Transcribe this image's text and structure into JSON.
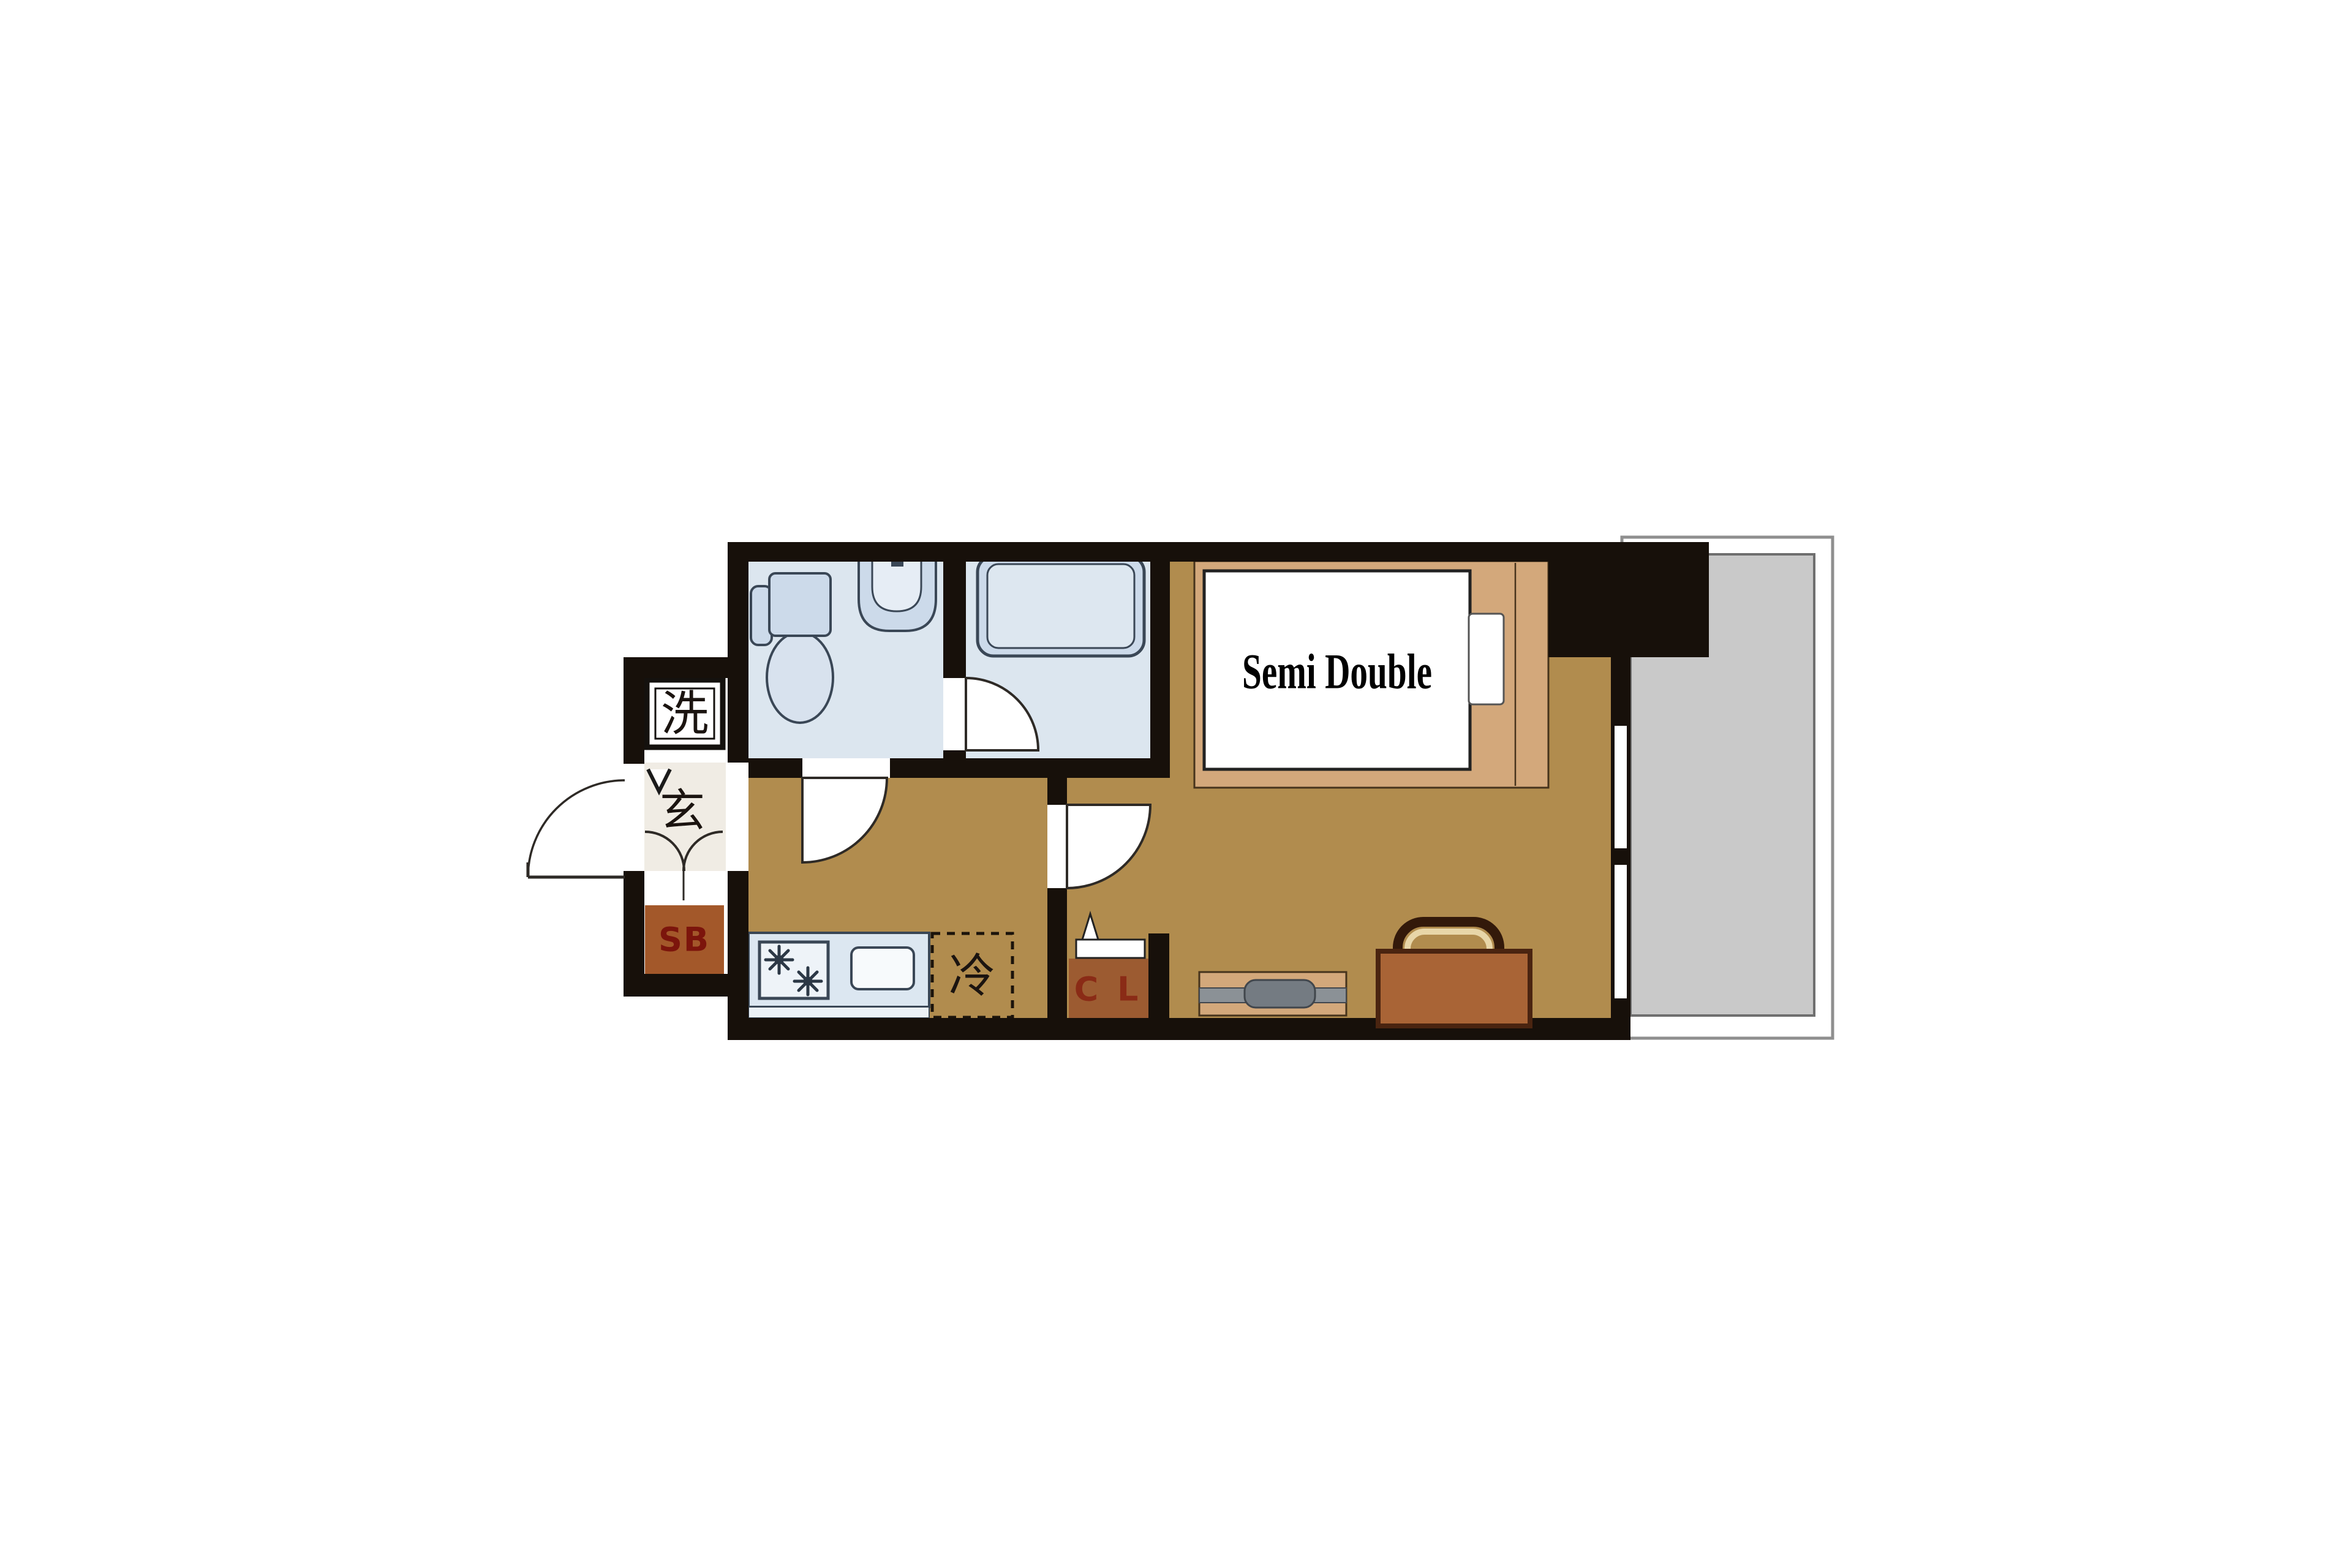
{
  "floorplan": {
    "type": "japanese-apartment-1K-floorplan",
    "labels": {
      "washer": "洗",
      "entrance": "玄",
      "shoe_box": "SB",
      "refrigerator": "冷",
      "closet": "C L",
      "bed": "Semi Double"
    },
    "rooms": [
      {
        "name": "toilet-room",
        "fixtures": [
          "toilet",
          "hand-basin"
        ]
      },
      {
        "name": "bathroom",
        "fixtures": [
          "bathtub"
        ]
      },
      {
        "name": "kitchen-hallway",
        "fixtures": [
          "two-burner-stove",
          "kitchen-sink",
          "refrigerator-space"
        ]
      },
      {
        "name": "entrance-hall",
        "fixtures": [
          "washing-machine-space",
          "shoe-box",
          "front-door"
        ]
      },
      {
        "name": "bedroom",
        "fixtures": [
          "semi-double-bed",
          "pillow",
          "closet",
          "tv-board",
          "suitcase"
        ]
      },
      {
        "name": "balcony",
        "fixtures": [
          "sliding-window"
        ]
      }
    ],
    "colors": {
      "background": "#ffffff",
      "wall": "#17100a",
      "floor_tan": "#b18c4e",
      "wet_room_blue": "#dce6ef",
      "fixture_fill": "#ccdaea",
      "fixture_outline": "#3a4756",
      "counter_blue": "#dce7f1",
      "genkan_beige": "#f0ece4",
      "shoe_box_brown": "#a3582a",
      "shoe_box_text": "#7c150c",
      "closet_brown": "#9c5b31",
      "closet_text": "#8a2b16",
      "bed_platform_tan": "#d3a87b",
      "mattress_white": "#ffffff",
      "balcony_gray": "#c9c9c9",
      "balcony_border": "#6f6f6f",
      "balcony_outer_border": "#8f8f8f",
      "suitcase_brown": "#a96436",
      "suitcase_outline": "#33190a",
      "handle_cream": "#e8d6a8",
      "table_stripe_gray": "#8b9196",
      "tv_gray": "#747b82",
      "door_arc_stroke": "#2e2a26"
    }
  }
}
